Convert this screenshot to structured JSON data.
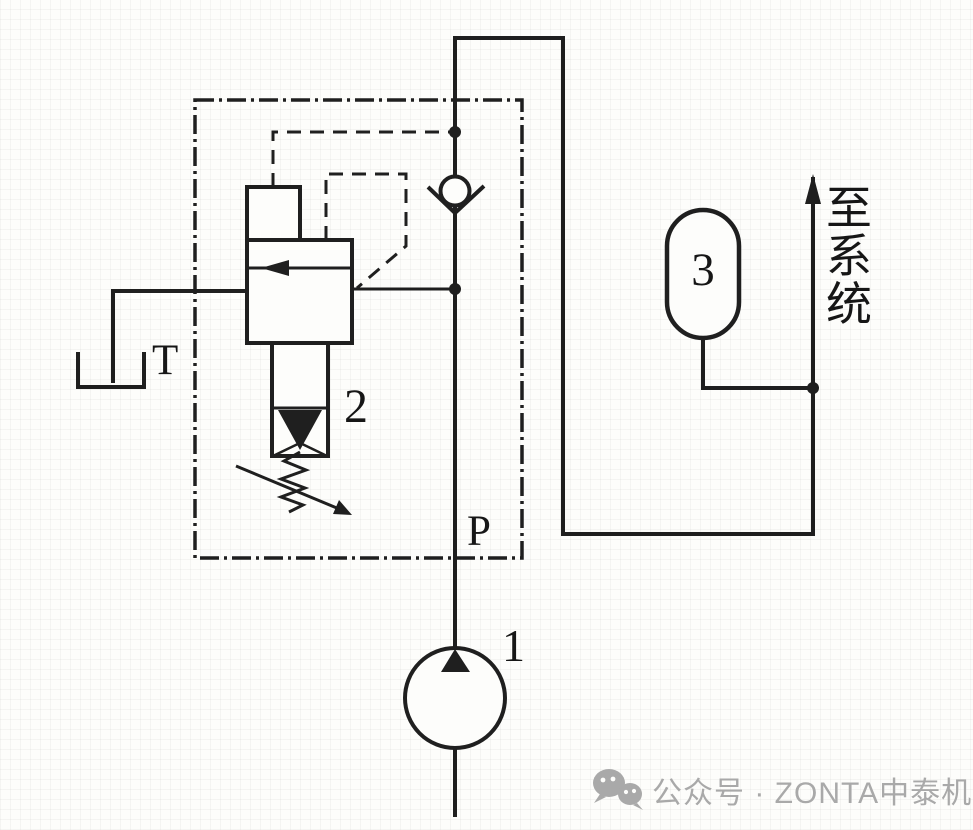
{
  "diagram": {
    "title_hint": "hydraulic unloading circuit with accumulator",
    "labels": {
      "tank_port": "T",
      "unloading_valve": "2",
      "pressure_port": "P",
      "accumulator": "3",
      "pump": "1",
      "to_system": "至系统",
      "to_system_chars": [
        "至",
        "系",
        "统"
      ]
    },
    "colors": {
      "line": "#1f1f1f",
      "background": "#fdfdfb",
      "watermark": "#a9a9a9"
    },
    "watermark": {
      "icon": "wechat-icon",
      "text": "公众号 · ZONTA中泰机电"
    }
  }
}
